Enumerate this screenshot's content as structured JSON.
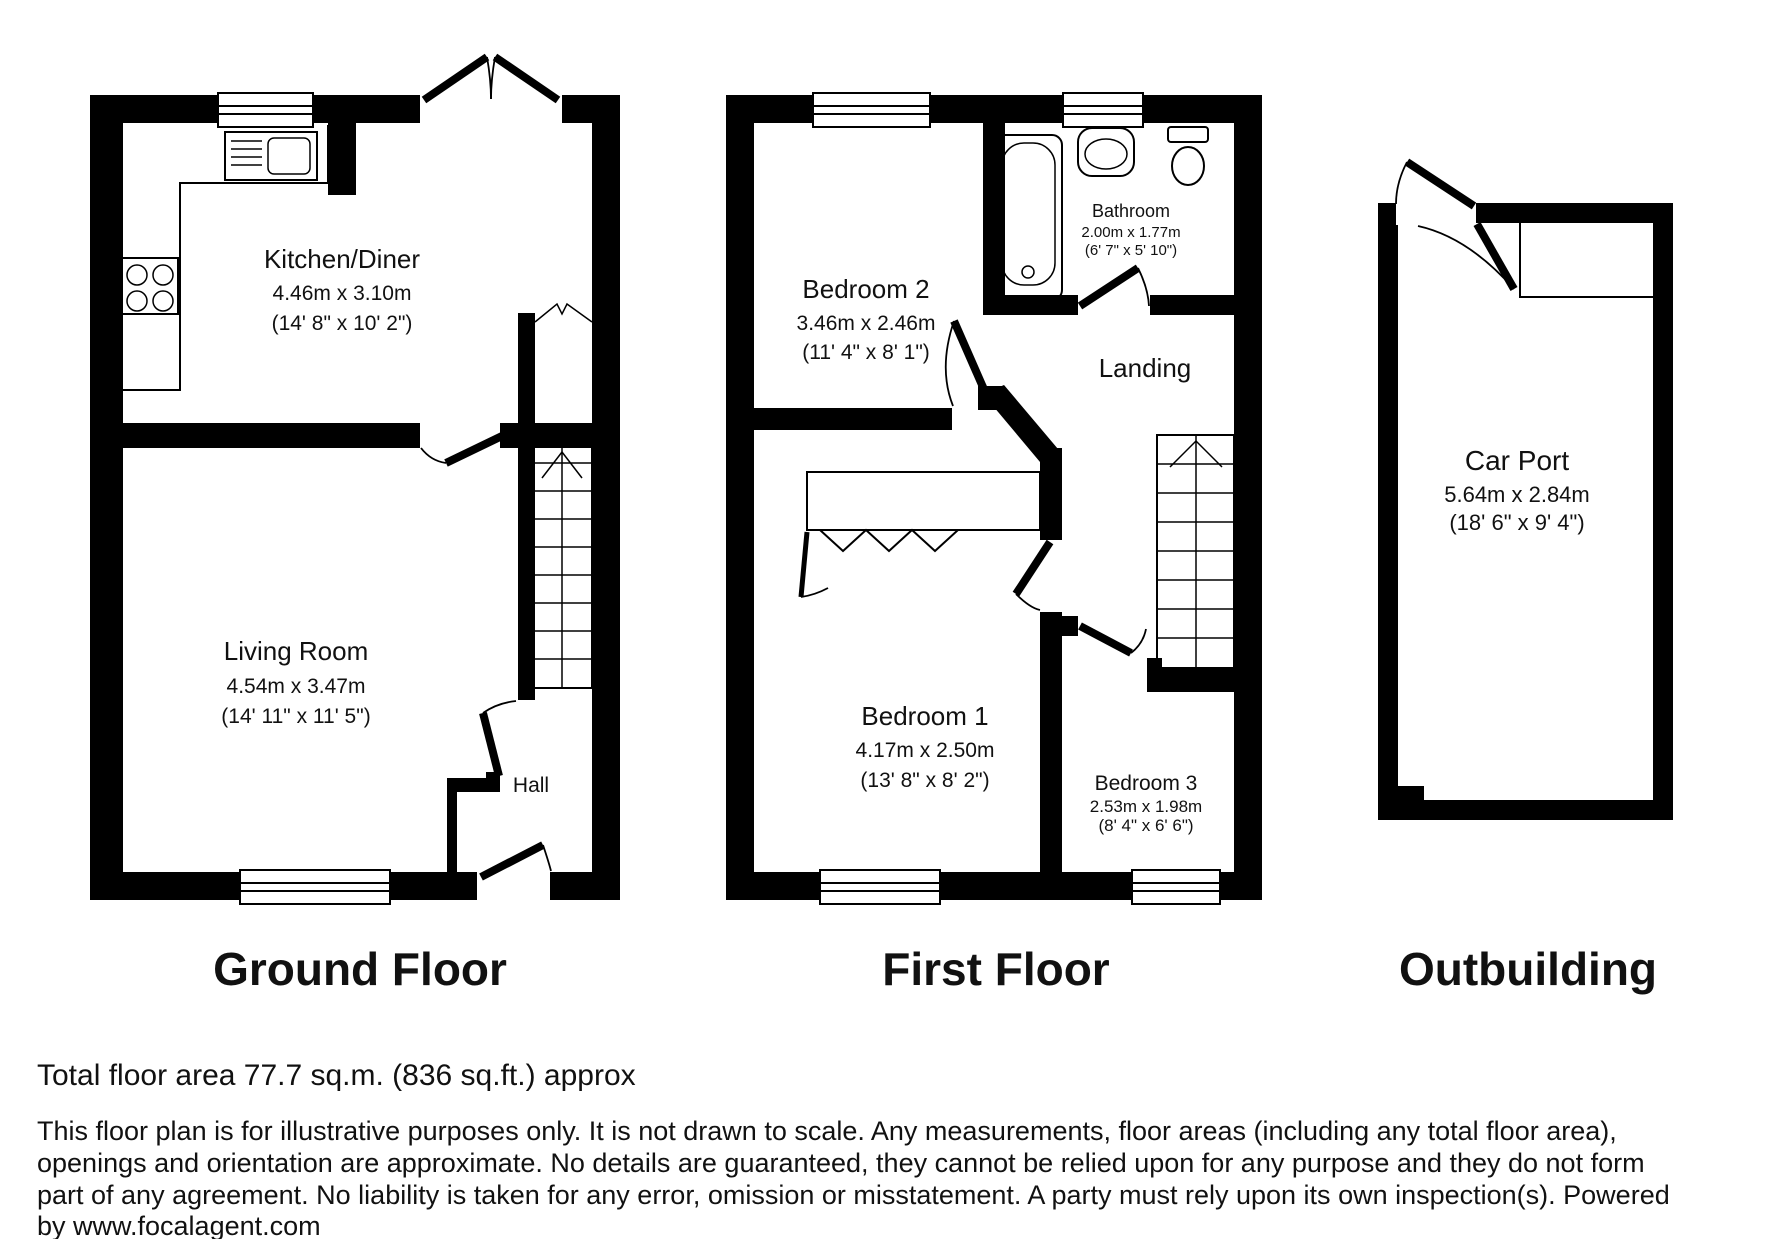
{
  "plans": {
    "ground": {
      "title": "Ground Floor",
      "kitchen": {
        "name": "Kitchen/Diner",
        "metric": "4.46m x 3.10m",
        "imperial": "(14' 8\" x 10' 2\")"
      },
      "living": {
        "name": "Living Room",
        "metric": "4.54m x 3.47m",
        "imperial": "(14' 11\" x 11' 5\")"
      },
      "hall": {
        "name": "Hall"
      }
    },
    "first": {
      "title": "First Floor",
      "bedroom2": {
        "name": "Bedroom 2",
        "metric": "3.46m x 2.46m",
        "imperial": "(11' 4\" x 8' 1\")"
      },
      "bathroom": {
        "name": "Bathroom",
        "metric": "2.00m x 1.77m",
        "imperial": "(6' 7\" x 5' 10\")"
      },
      "landing": {
        "name": "Landing"
      },
      "bedroom1": {
        "name": "Bedroom 1",
        "metric": "4.17m x 2.50m",
        "imperial": "(13' 8\" x 8' 2\")"
      },
      "bedroom3": {
        "name": "Bedroom 3",
        "metric": "2.53m x 1.98m",
        "imperial": "(8' 4\" x 6' 6\")"
      }
    },
    "outbuilding": {
      "title": "Outbuilding",
      "carport": {
        "name": "Car Port",
        "metric": "5.64m x 2.84m",
        "imperial": "(18' 6\" x 9' 4\")"
      }
    }
  },
  "footer": {
    "total_area": "Total floor area 77.7 sq.m. (836 sq.ft.) approx",
    "disclaimer": [
      "This floor plan is for illustrative purposes only. It is not drawn to scale. Any measurements, floor areas (including any total floor area),",
      "openings and orientation are approximate. No details are guaranteed, they cannot be relied upon for any purpose and they do not form",
      "part of any agreement. No liability is taken for any error, omission or misstatement. A party must rely upon its own inspection(s). Powered",
      "by www.focalagent.com"
    ]
  },
  "colors": {
    "wall": "#000000",
    "background": "#ffffff",
    "text": "#111111"
  }
}
